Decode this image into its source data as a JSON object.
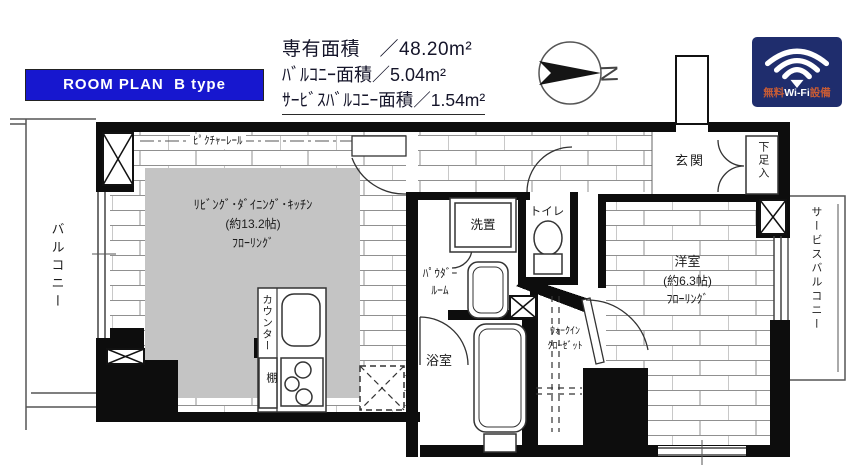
{
  "header": {
    "banner_label": "ROOM PLAN  B type",
    "area_lines": [
      "専有面積　／48.20m²",
      "ﾊﾞﾙｺﾆｰ面積／5.04m²",
      "ｻｰﾋﾞｽﾊﾞﾙｺﾆｰ面積／1.54m²"
    ],
    "compass_letter": "N",
    "wifi": {
      "left": "無料",
      "mid": "Wi-Fi",
      "right": "設備"
    }
  },
  "plan": {
    "balcony": "バルコニー",
    "picture_rail": "ﾋﾟｸﾁｬｰﾚｰﾙ",
    "ldk": {
      "line1": "ﾘﾋﾞﾝｸﾞ･ﾀﾞｲﾆﾝｸﾞ･ｷｯﾁﾝ",
      "line2": "(約13.2帖)",
      "line3": "ﾌﾛｰﾘﾝｸﾞ"
    },
    "counter": "カウンター",
    "shelf": "棚",
    "powder": {
      "line1": "ﾊﾟｳﾀﾞｰ",
      "line2": "ﾙｰﾑ"
    },
    "washer": "洗置",
    "toilet": "トイレ",
    "bath": "浴室",
    "wic": {
      "line1": "ｳｫｰｸｲﾝ",
      "line2": "ｸﾛｰｾﾞｯﾄ"
    },
    "entrance": "玄関",
    "shoe": "下足入",
    "western": {
      "line1": "洋室",
      "line2": "(約6.3帖)",
      "line3": "ﾌﾛｰﾘﾝｸﾞ"
    },
    "service_balcony": "サービスバルコニー"
  },
  "colors": {
    "banner_bg": "#1717cf",
    "wifi_badge_bg": "#1f2d6d",
    "wifi_accent": "#c75b35",
    "ldk_gray": "#c4c4c4",
    "wall_black": "#0d0d0d"
  }
}
